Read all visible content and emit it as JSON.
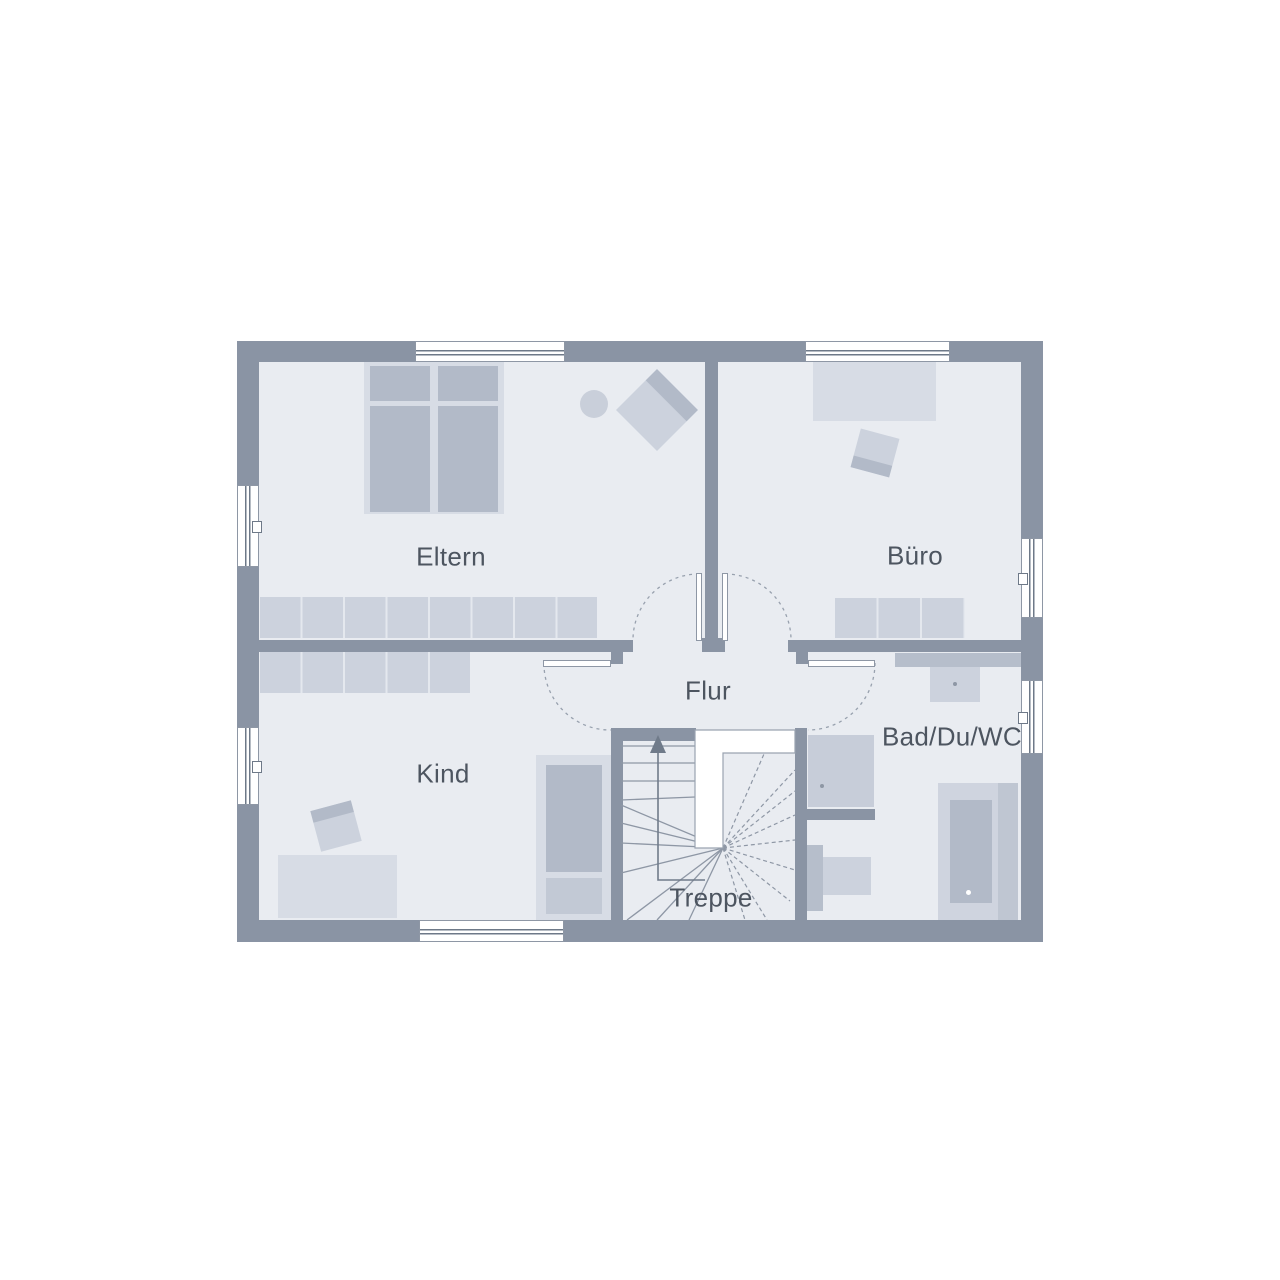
{
  "plan": {
    "type": "floor-plan",
    "rooms": {
      "eltern": {
        "label": "Eltern"
      },
      "buero": {
        "label": "Büro"
      },
      "kind": {
        "label": "Kind"
      },
      "flur": {
        "label": "Flur"
      },
      "bad": {
        "label": "Bad/Du/WC"
      },
      "treppe": {
        "label": "Treppe"
      }
    },
    "colors": {
      "wall": "#8a94a4",
      "floor": "#e9ecf1",
      "furnLight": "#d7dce5",
      "furnMid": "#ccd2dd",
      "furnDark": "#b2bac8",
      "furnCounter": "#b6becb",
      "line": "#8e97a5",
      "text": "#4d5560",
      "background": "#ffffff"
    }
  }
}
